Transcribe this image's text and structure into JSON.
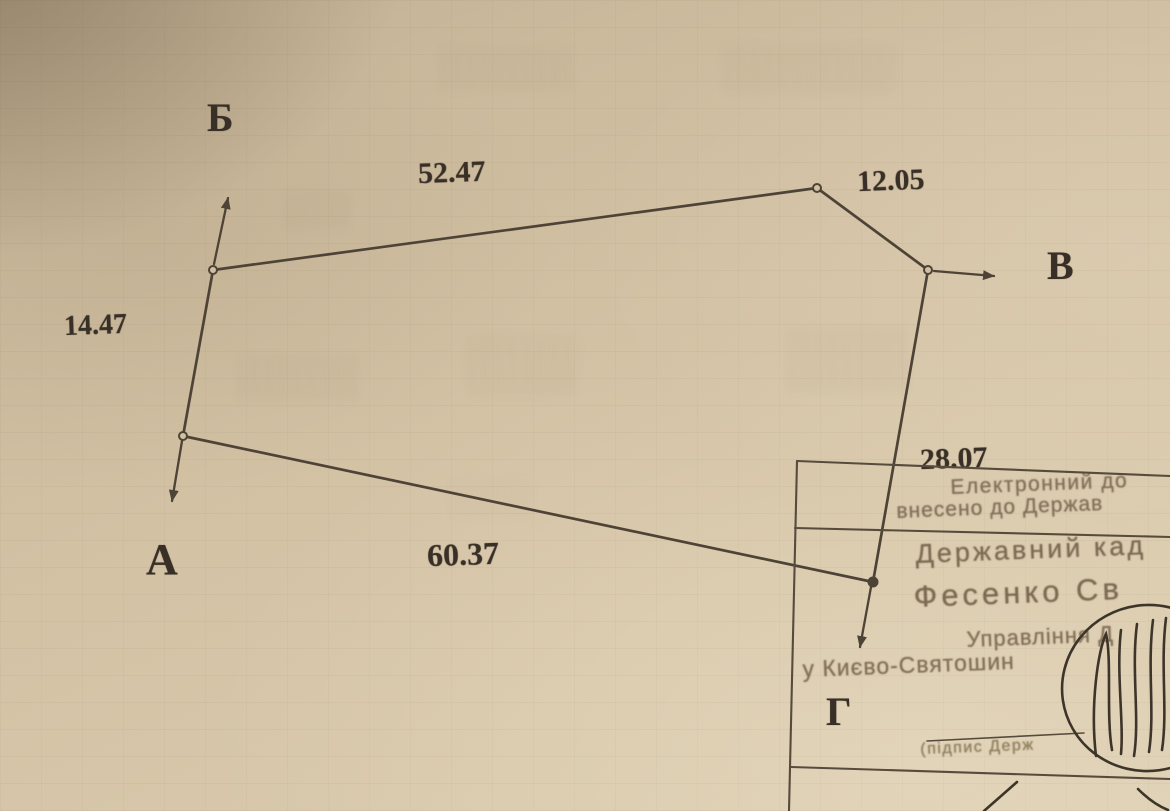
{
  "document": {
    "kind_note": "scanned cadastral parcel sketch"
  },
  "parcel_sketch": {
    "vertex_labels": {
      "b": "Б",
      "v": "В",
      "a": "А",
      "g": "Г"
    },
    "side_lengths": {
      "a_to_b": "14.47",
      "b_to_corner": "52.47",
      "corner_to_v": "12.05",
      "v_to_g": "28.07",
      "g_to_a": "60.37"
    }
  },
  "stamp": {
    "entry_note_line1": "Електронний до",
    "entry_note_line2": "внесено до Держав",
    "registrar_title": "Державний кад",
    "registrar_name": "Фесенко Св",
    "office_line1": "Управління Д",
    "office_line2": "у Києво-Святошин",
    "signature_caption": "(підпис Держ"
  },
  "colors": {
    "paper": "#d3c1a4",
    "drawing_ink": "#4d4336",
    "label_ink": "#383026",
    "stamp_ink": "#83705a"
  }
}
